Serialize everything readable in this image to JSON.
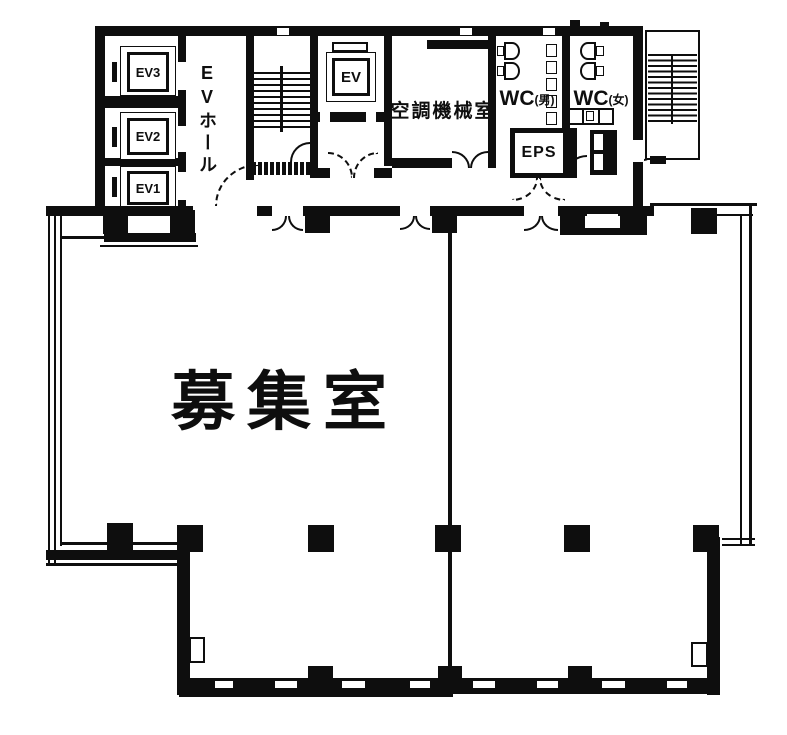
{
  "plan": {
    "title": "building-floor-plan",
    "colors": {
      "ink": "#0e0e0e",
      "paper": "#ffffff"
    },
    "main_room_label": "募集室",
    "ev_hall_label": "EVホール",
    "machine_room_label": "空調機械室",
    "wc_men": {
      "main": "WC",
      "sub": "(男)"
    },
    "wc_women": {
      "main": "WC",
      "sub": "(女)"
    },
    "eps_label": "EPS",
    "service_elevator_label": "EV",
    "elevators": [
      {
        "label": "EV3"
      },
      {
        "label": "EV2"
      },
      {
        "label": "EV1"
      }
    ]
  }
}
